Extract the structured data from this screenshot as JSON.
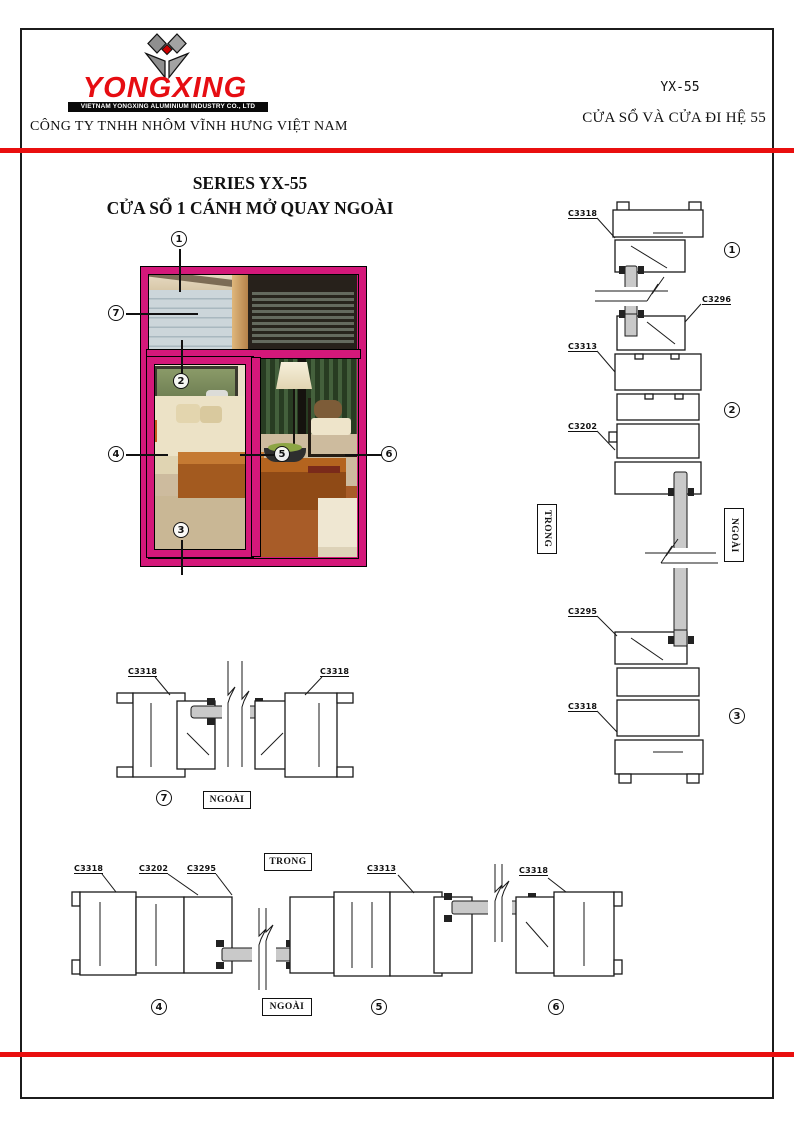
{
  "header": {
    "brand": "YONGXING",
    "brand_tagline": "VIETNAM YONGXING ALUMINIUM INDUSTRY CO., LTD",
    "company": "CÔNG TY TNHH NHÔM VĨNH HƯNG VIỆT NAM",
    "series_code": "YX-55",
    "series_name": "CỬA SỔ VÀ CỬA ĐI HỆ 55"
  },
  "title": {
    "line1": "SERIES YX-55",
    "line2": "CỬA SỔ 1 CÁNH MỞ QUAY NGOÀI"
  },
  "side_labels": {
    "inside": "TRONG",
    "outside": "NGOÀI"
  },
  "callouts": {
    "c1": "1",
    "c2": "2",
    "c3": "3",
    "c4": "4",
    "c5": "5",
    "c6": "6",
    "c7": "7"
  },
  "profiles": {
    "v_top": "C3318",
    "v_c3296": "C3296",
    "v_c3313": "C3313",
    "v_c3202": "C3202",
    "v_c3295": "C3295",
    "v_bottom": "C3318",
    "h7_left": "C3318",
    "h7_right": "C3318",
    "hb_1": "C3318",
    "hb_2": "C3202",
    "hb_3": "C3295",
    "hb_4": "C3313",
    "hb_5": "C3318"
  },
  "colors": {
    "accent_red": "#e90f0f",
    "frame_magenta": "#d4187a",
    "logo_red": "#e60d12"
  }
}
